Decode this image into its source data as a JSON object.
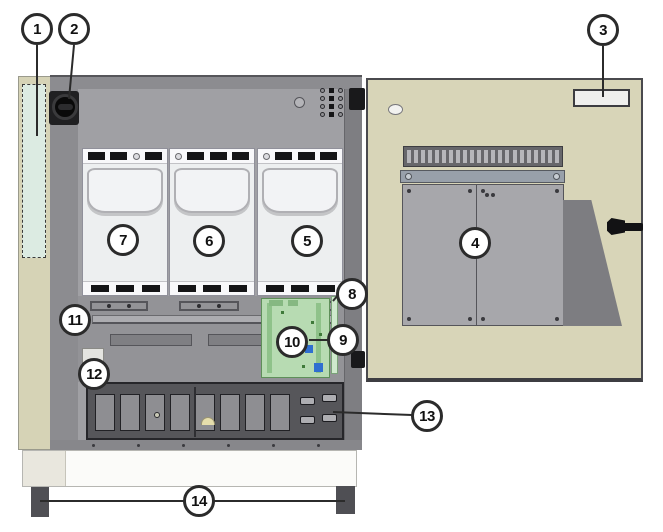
{
  "callouts": [
    {
      "number": "1",
      "target": "side-panel-marked-area"
    },
    {
      "number": "2",
      "target": "rotary-switch"
    },
    {
      "number": "3",
      "target": "door-label"
    },
    {
      "number": "4",
      "target": "door-panel-assembly"
    },
    {
      "number": "5",
      "target": "power-module-right"
    },
    {
      "number": "6",
      "target": "power-module-middle"
    },
    {
      "number": "7",
      "target": "power-module-left"
    },
    {
      "number": "8",
      "target": "right-edge-strip-upper"
    },
    {
      "number": "9",
      "target": "right-edge-strip-lower"
    },
    {
      "number": "10",
      "target": "circuit-board"
    },
    {
      "number": "11",
      "target": "support-rail"
    },
    {
      "number": "12",
      "target": "small-side-label"
    },
    {
      "number": "13",
      "target": "terminal-connectors"
    },
    {
      "number": "14",
      "target": "cabinet-feet"
    }
  ],
  "colors": {
    "background": "#ffffff",
    "panel_beige": "#d6d3b6",
    "marked_area_teal": "#dcebe2",
    "frame_gray": "#8c8c90",
    "interior_gray": "#a0a0a4",
    "module_white": "#edeff0",
    "pcb_green": "#b7dbb2",
    "terminal_dark": "#56565a",
    "connector_blue": "#2f6fd0",
    "callout_outline": "#2b2b2b"
  }
}
